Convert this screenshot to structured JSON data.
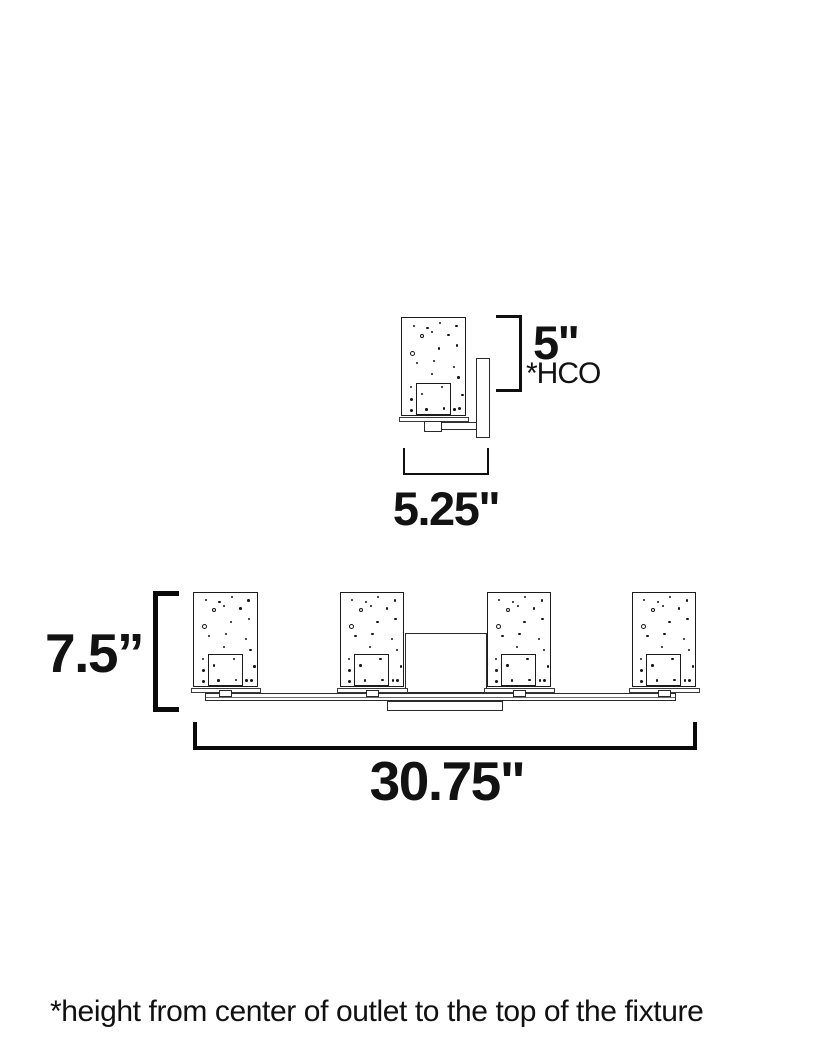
{
  "colors": {
    "background": "#ffffff",
    "line": "#1c1c1c",
    "text": "#121212"
  },
  "top_diagram": {
    "height_value": "5\"",
    "height_note": "*HCO",
    "width_value": "5.25\""
  },
  "bottom_diagram": {
    "height_value": "7.5”",
    "width_value": "30.75\""
  },
  "footnote": "*height from center of outlet to the top of the fixture",
  "speckle_pattern": [
    {
      "x": 17,
      "y": 7,
      "s": 2
    },
    {
      "x": 39,
      "y": 9,
      "s": 2.5
    },
    {
      "x": 59,
      "y": 4,
      "s": 2
    },
    {
      "x": 85,
      "y": 7,
      "s": 2.5
    },
    {
      "x": 47,
      "y": 13,
      "s": 2
    },
    {
      "x": 72,
      "y": 16,
      "s": 2.5
    },
    {
      "x": 29,
      "y": 17,
      "s": 4,
      "ring": true
    },
    {
      "x": 86,
      "y": 27,
      "s": 2.5
    },
    {
      "x": 57,
      "y": 30,
      "s": 2.5
    },
    {
      "x": 13,
      "y": 34,
      "s": 5,
      "ring": true
    },
    {
      "x": 22,
      "y": 45,
      "s": 2.5
    },
    {
      "x": 49,
      "y": 43,
      "s": 2.5
    },
    {
      "x": 81,
      "y": 49,
      "s": 2
    },
    {
      "x": 46,
      "y": 57,
      "s": 2
    },
    {
      "x": 88,
      "y": 60,
      "s": 2.5
    },
    {
      "x": 12,
      "y": 70,
      "s": 2
    },
    {
      "x": 62,
      "y": 70,
      "s": 2.5
    },
    {
      "x": 30,
      "y": 77,
      "s": 2.5
    },
    {
      "x": 95,
      "y": 78,
      "s": 2.5
    },
    {
      "x": 12,
      "y": 82,
      "s": 3
    },
    {
      "x": 37,
      "y": 93,
      "s": 2.5
    },
    {
      "x": 82,
      "y": 93,
      "s": 2.5
    },
    {
      "x": 12,
      "y": 94,
      "s": 3
    },
    {
      "x": 89,
      "y": 92,
      "s": 3
    },
    {
      "x": 65,
      "y": 92,
      "s": 2.5
    }
  ],
  "drawing": {
    "shade_outer_w": 65.5,
    "top_shade": {
      "x": 401,
      "y": 317,
      "w": 66,
      "h": 100
    },
    "bottom_shades_x": [
      193,
      339.5,
      486.5,
      631.5
    ],
    "bottom_shade_y": 591.5,
    "bottom_shade_h": 96.5
  }
}
